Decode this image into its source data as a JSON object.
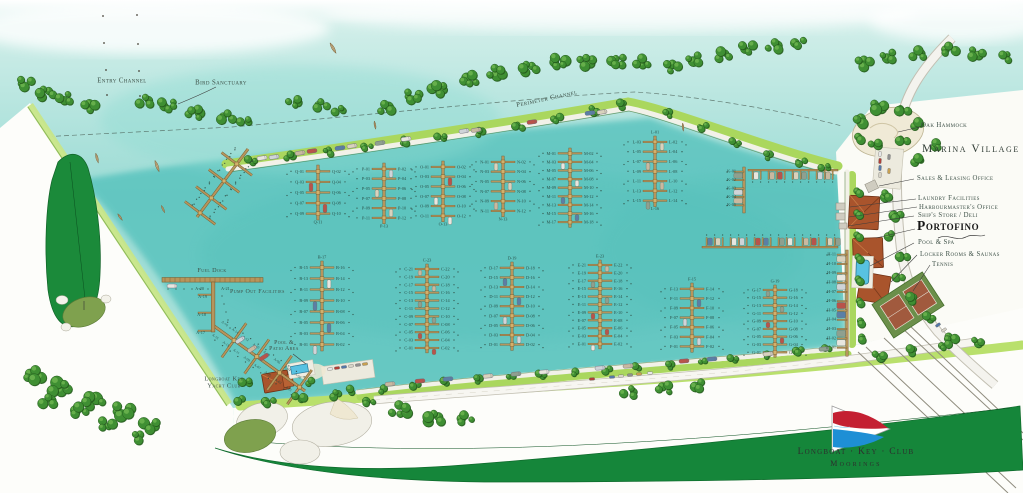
{
  "map_labels": {
    "entry_channel": "Entry Channel",
    "bird_sanctuary": "Bird Sanctuary",
    "perimeter_channel": "Perimeter Channel",
    "oak_hammock": "Oak Hammock",
    "marina_village": "Marina Village",
    "sales_leasing_office": "Sales & Leasing Office",
    "laundry_facilities": "Laundry Facilities",
    "harbourmasters_office": "Harbourmaster's Office",
    "ships_store_deli": "Ship's Store / Deli",
    "portofino": "Portofino",
    "pool_spa": "Pool & Spa",
    "locker_rooms_saunas": "Locker Rooms & Saunas",
    "tennis": "Tennis",
    "fuel_dock": "Fuel Dock",
    "pump_out_facilities": "Pump Out Facilities",
    "pool_patio_line1": "Pool &",
    "pool_patio_line2": "Patio Area",
    "yacht_club_line1": "Longboat Key",
    "yacht_club_line2": "Yacht Club"
  },
  "logo": {
    "line1": "Longboat · Key · Club",
    "line2": "Moorings"
  },
  "fuel_area_slips": {
    "a17": "A-17",
    "a18": "A-18",
    "a19": "A-19",
    "a20": "A-20",
    "a21": "A-21"
  },
  "docks": [
    {
      "name": "Q",
      "type": "pairs",
      "pairs": [
        [
          "Q-01",
          "Q-02"
        ],
        [
          "Q-03",
          "Q-04"
        ],
        [
          "Q-05",
          "Q-06"
        ],
        [
          "Q-07",
          "Q-08"
        ],
        [
          "Q-09",
          "Q-10"
        ]
      ],
      "end_label": "Q-11"
    },
    {
      "name": "P",
      "type": "pairs",
      "pairs": [
        [
          "P-01",
          "P-02"
        ],
        [
          "P-03",
          "P-04"
        ],
        [
          "P-05",
          "P-06"
        ],
        [
          "P-07",
          "P-08"
        ],
        [
          "P-09",
          "P-10"
        ],
        [
          "P-11",
          "P-12"
        ]
      ],
      "end_label": "P-13"
    },
    {
      "name": "O",
      "type": "pairs",
      "pairs": [
        [
          "O-01",
          "O-02"
        ],
        [
          "O-03",
          "O-04"
        ],
        [
          "O-05",
          "O-06"
        ],
        [
          "O-07",
          "O-08"
        ],
        [
          "O-09",
          "O-10"
        ],
        [
          "O-11",
          "O-12"
        ]
      ],
      "end_label": "O-13"
    },
    {
      "name": "N",
      "type": "pairs",
      "pairs": [
        [
          "N-01",
          "N-02"
        ],
        [
          "N-03",
          "N-04"
        ],
        [
          "N-05",
          "N-06"
        ],
        [
          "N-07",
          "N-08"
        ],
        [
          "N-09",
          "N-10"
        ],
        [
          "N-11",
          "N-12"
        ]
      ],
      "end_label": "N-13"
    },
    {
      "name": "M",
      "type": "pairs",
      "pairs": [
        [
          "M-01",
          "M-02"
        ],
        [
          "M-03",
          "M-04"
        ],
        [
          "M-05",
          "M-06"
        ],
        [
          "M-07",
          "M-08"
        ],
        [
          "M-09",
          "M-10"
        ],
        [
          "M-11",
          "M-12"
        ],
        [
          "M-13",
          "M-14"
        ],
        [
          "M-15",
          "M-16"
        ],
        [
          "M-17",
          "M-18"
        ]
      ]
    },
    {
      "name": "L",
      "type": "pairs",
      "top_label": "L-01",
      "pairs": [
        [
          "L-03",
          "L-02"
        ],
        [
          "L-05",
          "L-04"
        ],
        [
          "L-07",
          "L-06"
        ],
        [
          "L-09",
          "L-08"
        ],
        [
          "L-11",
          "L-10"
        ],
        [
          "L-13",
          "L-12"
        ],
        [
          "L-15",
          "L-14"
        ]
      ],
      "end_label": "L-16"
    },
    {
      "name": "B",
      "type": "pairs",
      "top_label": "B-17",
      "pairs": [
        [
          "B-15",
          "B-16"
        ],
        [
          "B-13",
          "B-14"
        ],
        [
          "B-11",
          "B-12"
        ],
        [
          "B-09",
          "B-10"
        ],
        [
          "B-07",
          "B-08"
        ],
        [
          "B-05",
          "B-06"
        ],
        [
          "B-03",
          "B-04"
        ],
        [
          "B-01",
          "B-02"
        ]
      ]
    },
    {
      "name": "C",
      "type": "pairs",
      "top_label": "C-23",
      "pairs": [
        [
          "C-21",
          "C-22"
        ],
        [
          "C-19",
          "C-20"
        ],
        [
          "C-17",
          "C-18"
        ],
        [
          "C-15",
          "C-16"
        ],
        [
          "C-13",
          "C-14"
        ],
        [
          "C-11",
          "C-12"
        ],
        [
          "C-09",
          "C-10"
        ],
        [
          "C-07",
          "C-08"
        ],
        [
          "C-05",
          "C-06"
        ],
        [
          "C-03",
          "C-04"
        ],
        [
          "C-01",
          "C-02"
        ]
      ]
    },
    {
      "name": "D",
      "type": "pairs",
      "top_label": "D-19",
      "pairs": [
        [
          "D-17",
          "D-18"
        ],
        [
          "D-15",
          "D-16"
        ],
        [
          "D-13",
          "D-14"
        ],
        [
          "D-11",
          "D-12"
        ],
        [
          "D-09",
          "D-10"
        ],
        [
          "D-07",
          "D-08"
        ],
        [
          "D-05",
          "D-06"
        ],
        [
          "D-03",
          "D-04"
        ],
        [
          "D-01",
          "D-02"
        ]
      ]
    },
    {
      "name": "E",
      "type": "pairs",
      "top_label": "E-23",
      "pairs": [
        [
          "E-21",
          "E-22"
        ],
        [
          "E-19",
          "E-20"
        ],
        [
          "E-17",
          "E-18"
        ],
        [
          "E-15",
          "E-16"
        ],
        [
          "E-13",
          "E-14"
        ],
        [
          "E-11",
          "E-12"
        ],
        [
          "E-09",
          "E-10"
        ],
        [
          "E-07",
          "E-08"
        ],
        [
          "E-05",
          "E-06"
        ],
        [
          "E-03",
          "E-04"
        ],
        [
          "E-01",
          "E-02"
        ]
      ]
    },
    {
      "name": "F",
      "type": "pairs",
      "top_label": "F-15",
      "pairs": [
        [
          "F-13",
          "F-14"
        ],
        [
          "F-11",
          "F-12"
        ],
        [
          "F-09",
          "F-10"
        ],
        [
          "F-07",
          "F-08"
        ],
        [
          "F-05",
          "F-06"
        ],
        [
          "F-03",
          "F-04"
        ],
        [
          "F-01",
          "F-02"
        ]
      ]
    },
    {
      "name": "G",
      "type": "pairs",
      "top_label": "G-19",
      "pairs": [
        [
          "G-17",
          "G-18"
        ],
        [
          "G-15",
          "G-16"
        ],
        [
          "G-13",
          "G-14"
        ],
        [
          "G-11",
          "G-12"
        ],
        [
          "G-09",
          "G-10"
        ],
        [
          "G-07",
          "G-08"
        ],
        [
          "G-05",
          "G-06"
        ],
        [
          "G-03",
          "G-04"
        ],
        [
          "G-01",
          "G-02"
        ]
      ]
    },
    {
      "name": "H",
      "type": "singles",
      "slips": [
        "H-11",
        "H-10",
        "H-09",
        "H-08",
        "H-07",
        "H-06",
        "H-05",
        "H-04",
        "H-03",
        "H-02",
        "H-01"
      ]
    },
    {
      "name": "K",
      "type": "singles",
      "slips": [
        "K-01",
        "K-02",
        "K-03",
        "K-04",
        "K-05"
      ]
    },
    {
      "name": "J",
      "type": "finger-row",
      "slips": []
    },
    {
      "name": "I",
      "type": "finger-row",
      "slips": []
    },
    {
      "name": "R",
      "type": "diagonal",
      "slips": []
    },
    {
      "name": "A",
      "type": "diagonal",
      "slips": [
        "A-16",
        "A-15",
        "A-14",
        "A-13",
        "A-12",
        "A-11",
        "A-10",
        "A-09",
        "A-08",
        "A-07",
        "A-06",
        "A-05",
        "A-04",
        "A-03",
        "A-02",
        "A-01"
      ]
    }
  ],
  "colors": {
    "water": "#9adbd4",
    "basin": "#5fc6c0",
    "island_green": "#3f8f33",
    "lawn": "#aad75e",
    "dock": "#b7955c",
    "dock_edge": "#73592b",
    "fairway": "#15863a",
    "roof": "#a9542c",
    "pool": "#58c2e2",
    "label": "#3d5047",
    "logo_red": "#c42032",
    "logo_blue": "#1e8fd5"
  }
}
